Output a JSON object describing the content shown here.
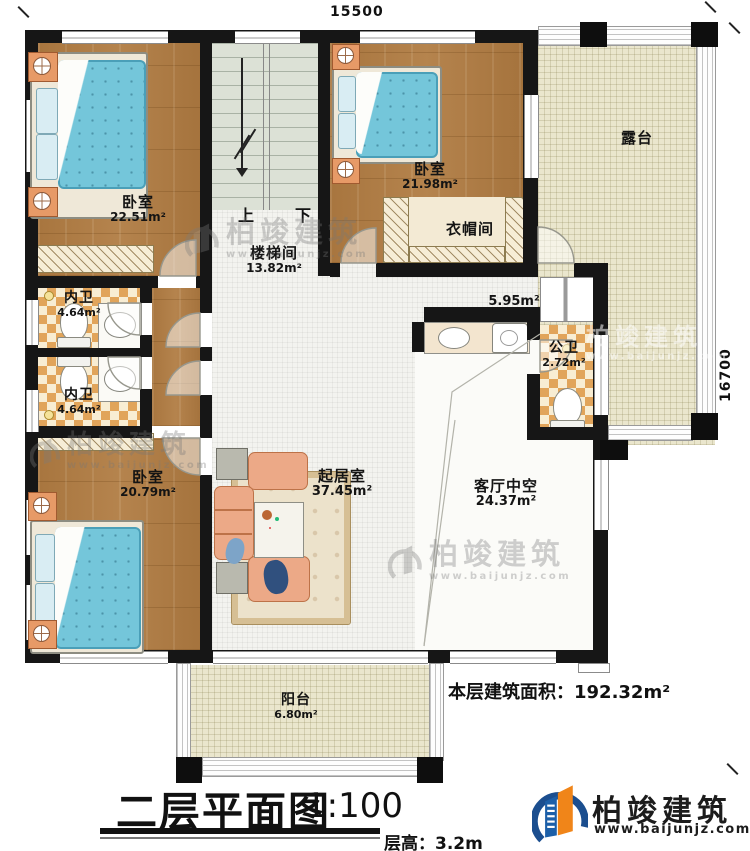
{
  "dimensions": {
    "top": "15500",
    "right": "16700"
  },
  "rooms": {
    "bedroom_tl": {
      "name": "卧室",
      "area": "22.51m²"
    },
    "stairwell": {
      "name": "楼梯间",
      "area": "13.82m²",
      "up": "上",
      "down": "下"
    },
    "bedroom_tr": {
      "name": "卧室",
      "area": "21.98m²"
    },
    "closet": {
      "name": "衣帽间"
    },
    "terrace": {
      "name": "露台"
    },
    "corridor": {
      "area": "5.95m²"
    },
    "public_bath": {
      "name": "公卫",
      "area": "2.72m²"
    },
    "bath_a": {
      "name": "内卫",
      "area": "4.64m²"
    },
    "bath_b": {
      "name": "内卫",
      "area": "4.64m²"
    },
    "bedroom_bl": {
      "name": "卧室",
      "area": "20.79m²"
    },
    "living": {
      "name": "起居室",
      "area": "37.45m²"
    },
    "void": {
      "name": "客厅中空",
      "area": "24.37m²"
    },
    "balcony": {
      "name": "阳台",
      "area": "6.80m²"
    }
  },
  "title_block": {
    "title": "二层平面图",
    "scale": "1:100",
    "floor_height": "层高：3.2m",
    "floor_area_label": "本层建筑面积：",
    "floor_area_value": "192.32m²"
  },
  "branding": {
    "logo_text": "柏竣建筑",
    "logo_url": "www.baijunjz.com"
  },
  "watermark": {
    "text": "柏竣建筑",
    "url": "www.baijunjz.com"
  },
  "colors": {
    "wall": "#161616",
    "wood_floor": "#b17d44",
    "white_tile": "#f3f3ef",
    "terrace_tile": "#eae6cd",
    "bath_checker_orange": "#e1a45a",
    "bath_checker_cream": "#f8edd3",
    "bed_blue": "#74c6da",
    "sofa_salmon": "#eca987",
    "logo_blue": "#1b4e8f",
    "logo_orange": "#f08519"
  }
}
